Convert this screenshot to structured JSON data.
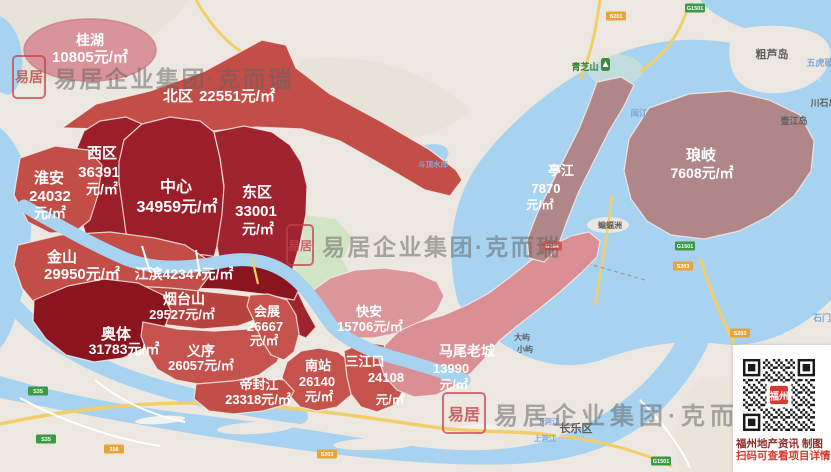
{
  "regions": [
    {
      "id": "guihu",
      "name": "桂湖",
      "value": "10805",
      "unit": "元/㎡"
    },
    {
      "id": "beiqu",
      "name": "北区",
      "value": "22551",
      "unit": "元/㎡"
    },
    {
      "id": "xiqu",
      "name": "西区",
      "value": "36391",
      "unit": "元/㎡"
    },
    {
      "id": "zhongxin",
      "name": "中心",
      "value": "34959",
      "unit": "元/㎡"
    },
    {
      "id": "dongqu",
      "name": "东区",
      "value": "33001",
      "unit": "元/㎡"
    },
    {
      "id": "huaian",
      "name": "淮安",
      "value": "24032",
      "unit": "元/㎡"
    },
    {
      "id": "jinshan",
      "name": "金山",
      "value": "29950",
      "unit": "元/㎡"
    },
    {
      "id": "jiangbin",
      "name": "江滨",
      "value": "42347",
      "unit": "元/㎡"
    },
    {
      "id": "yantaishan",
      "name": "烟台山",
      "value": "29527",
      "unit": "元/㎡"
    },
    {
      "id": "aoti",
      "name": "奥体",
      "value": "31783",
      "unit": "元/㎡"
    },
    {
      "id": "yixu",
      "name": "义序",
      "value": "26057",
      "unit": "元/㎡"
    },
    {
      "id": "huizhan",
      "name": "会展",
      "value": "26667",
      "unit": "元/㎡"
    },
    {
      "id": "nanzhan",
      "name": "南站",
      "value": "26140",
      "unit": "元/㎡"
    },
    {
      "id": "difengjiang",
      "name": "帝封江",
      "value": "23318",
      "unit": "元/㎡"
    },
    {
      "id": "sanjiangkou",
      "name": "三江口",
      "value": "24108",
      "unit": "元/㎡"
    },
    {
      "id": "kuaian",
      "name": "快安",
      "value": "15706",
      "unit": "元/㎡"
    },
    {
      "id": "mawei",
      "name": "马尾老城",
      "value": "13990",
      "unit": "元/㎡"
    },
    {
      "id": "tingjiang",
      "name": "亭江",
      "value": "7870",
      "unit": "元/㎡"
    },
    {
      "id": "langqi",
      "name": "琅岐",
      "value": "7608",
      "unit": "元/㎡"
    }
  ],
  "watermark": {
    "brand": "易居企业集团·克而瑞",
    "seal": "易居"
  },
  "qr": {
    "center": "福州",
    "caption1": "福州地产资讯 制图",
    "caption2": "扫码可查看项目详情"
  },
  "map_labels": {
    "culudao": "粗芦岛",
    "qingzhishan": "青芝山",
    "chuanshi": "川石岛",
    "hujiang": "壶江岛",
    "wuhu": "五虎礁",
    "minjiang": "闽江",
    "bianfuzhou": "蝙蝠洲",
    "dayu": "大屿",
    "xiaoyu": "小屿",
    "changle": "长乐区",
    "xiadongjiang": "下洞江",
    "shangdongjiang": "上洞江",
    "shuiku": "斗顶水库",
    "shimen": "石门"
  },
  "badges": [
    "G1501",
    "S201",
    "G1501",
    "S203",
    "G104",
    "S203",
    "G1501",
    "S35",
    "S35",
    "316",
    "S203"
  ],
  "colors": {
    "dark_red": "#9B1E28",
    "deep_red": "#8A151F",
    "east_red": "#A02430",
    "mid_red": "#C24E47",
    "pink": "#DC979B",
    "mauve": "#B18688",
    "guihu_pink": "#D9939A",
    "water": "#A8D3F0",
    "land": "#ECE8E1",
    "road_yellow": "#F2CE6B",
    "green": "#CFE5C1",
    "seal_red": "#C13E46",
    "qr_red": "#D63A30"
  }
}
